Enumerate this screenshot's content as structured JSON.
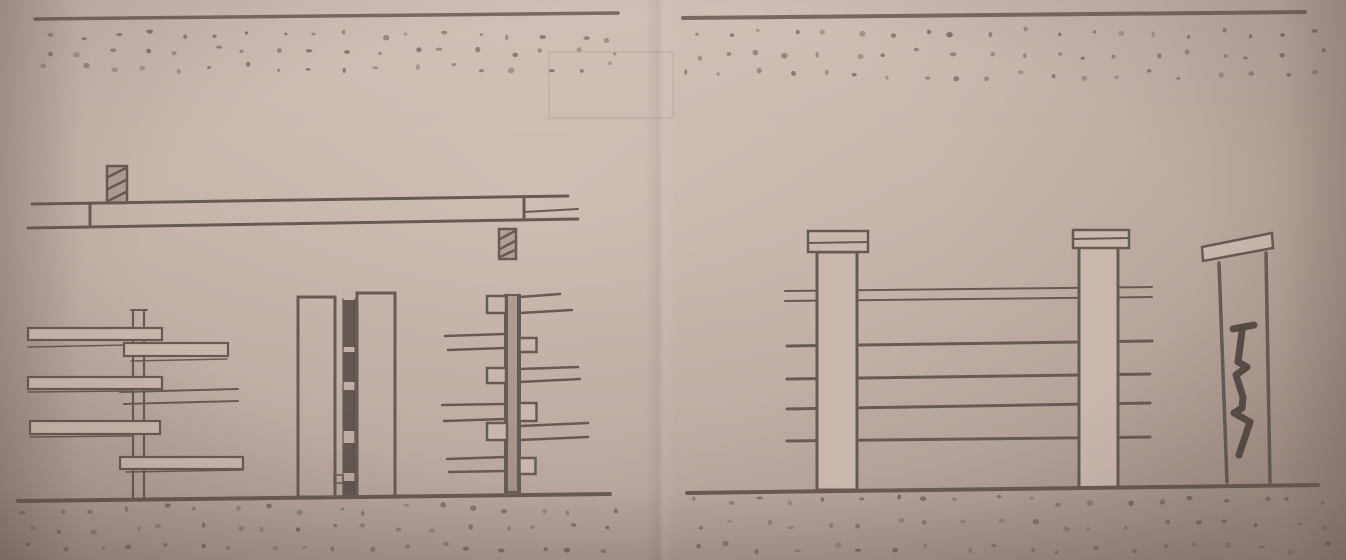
{
  "scene": {
    "description": "Photograph of a hand-drawn pencil construction sketch on paper showing fence building details in two panels",
    "panels": [
      {
        "name": "left-panel",
        "elements": [
          {
            "name": "top-soil-band",
            "label": "top edge line with stippled soil dots"
          },
          {
            "name": "plan-view-lap-joint",
            "label": "plan view of two lapped rails with hatched post sections on alternating sides"
          },
          {
            "name": "elevation-alternating-boards",
            "label": "fence post elevation with boards attached on alternating sides"
          },
          {
            "name": "profile-double-post",
            "label": "edge view of paired posts with dark board ends stacked between"
          },
          {
            "name": "elevation-spacer-blocks",
            "label": "fence post elevation with small spacer blocks and paired board edge lines"
          },
          {
            "name": "ground-line",
            "label": "ground line with stippled soil below"
          }
        ]
      },
      {
        "name": "right-panel",
        "elements": [
          {
            "name": "top-soil-band",
            "label": "top edge line with stippled soil dots"
          },
          {
            "name": "post-and-rail-fence",
            "label": "two capped posts carrying five horizontal rails with short stub ends"
          },
          {
            "name": "cracked-post",
            "label": "narrow post with tilted cap and bold zigzag crack"
          },
          {
            "name": "ground-line",
            "label": "ground line with stippled soil below"
          }
        ]
      }
    ]
  },
  "colors": {
    "paper_fill": "#c9b7ae",
    "paper_light": "#d6c4bb",
    "paper_dark": "#a3918a",
    "ink": "#665b54",
    "ink_dark": "#4e443e",
    "ink_faint": "#8d8179"
  },
  "stipple_bands": [
    {
      "name": "soil-stipple-top-left",
      "x0": 48,
      "x1": 612,
      "y0": 36,
      "y1": 67,
      "rows": 3,
      "cols": 18,
      "seed": 11
    },
    {
      "name": "soil-stipple-top-right",
      "x0": 692,
      "x1": 1318,
      "y0": 33,
      "y1": 75,
      "rows": 3,
      "cols": 20,
      "seed": 23
    },
    {
      "name": "soil-stipple-bottom-left",
      "x0": 30,
      "x1": 608,
      "y0": 509,
      "y1": 547,
      "rows": 3,
      "cols": 18,
      "seed": 37
    },
    {
      "name": "soil-stipple-bottom-right",
      "x0": 698,
      "x1": 1326,
      "y0": 501,
      "y1": 548,
      "rows": 3,
      "cols": 20,
      "seed": 53
    }
  ]
}
